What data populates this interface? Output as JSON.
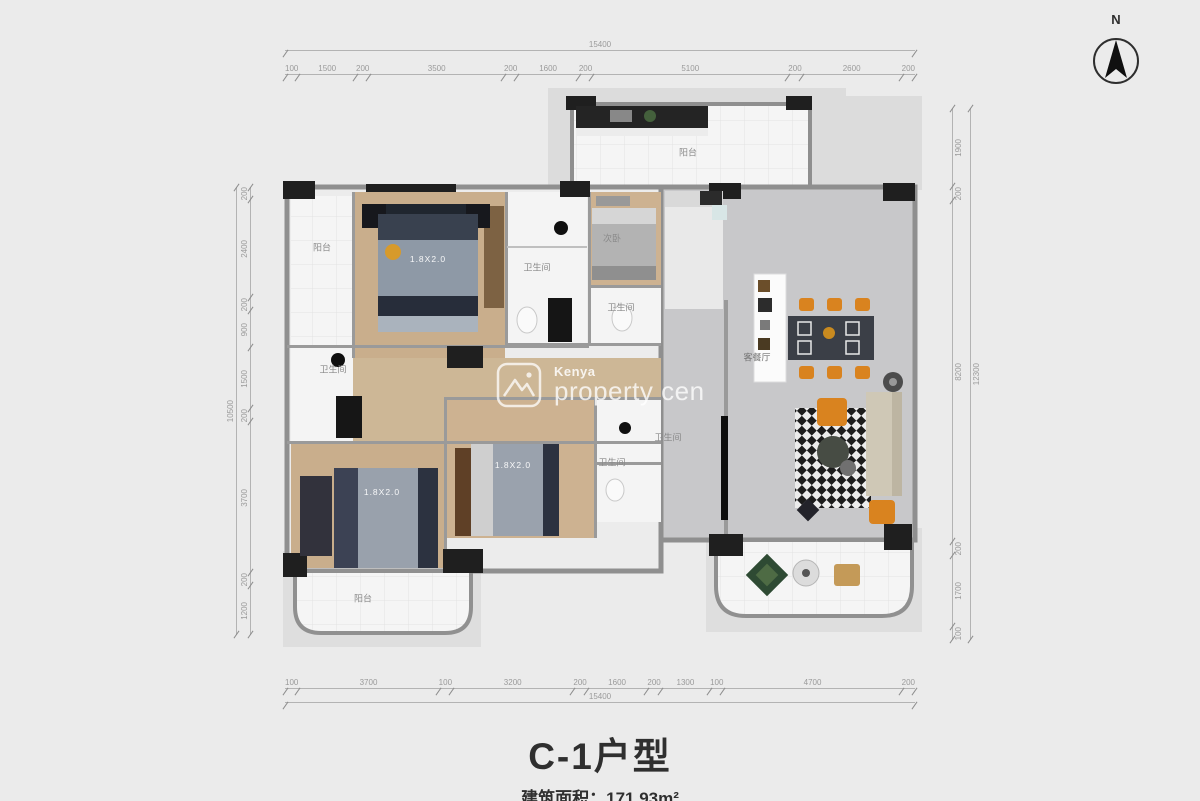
{
  "page": {
    "bg": "#ebebeb",
    "title": "C-1户型",
    "area_label": "建筑面积：171.93m²"
  },
  "compass": {
    "label": "N"
  },
  "watermark": {
    "brand": "Kenya",
    "text": "property cen"
  },
  "dimensions": {
    "top": {
      "total": "15400",
      "segments": [
        "100",
        "1500",
        "200",
        "3500",
        "200",
        "1600",
        "200",
        "5100",
        "200",
        "2600",
        "200"
      ]
    },
    "bottom": {
      "total": "15400",
      "segments": [
        "100",
        "3700",
        "100",
        "3200",
        "200",
        "1600",
        "200",
        "1300",
        "100",
        "4700",
        "200"
      ]
    },
    "left": {
      "total": "10500",
      "segments": [
        "200",
        "2400",
        "200",
        "900",
        "1500",
        "200",
        "3700",
        "200",
        "1200"
      ]
    },
    "right": {
      "total": "12300",
      "segments": [
        "1900",
        "200",
        "8200",
        "200",
        "1700",
        "100"
      ]
    }
  },
  "colors": {
    "accent_orange": "#d9831f",
    "wood_floor": "#c9ae8c",
    "marble_floor": "#c8c8ca",
    "wall_gray": "#8f8f8f",
    "column_black": "#1f1f1f"
  },
  "plan": {
    "labels": [
      {
        "text": "阳台",
        "x": 322,
        "y": 247,
        "style": ""
      },
      {
        "text": "阳台",
        "x": 688,
        "y": 152,
        "style": ""
      },
      {
        "text": "阳台",
        "x": 363,
        "y": 598,
        "style": ""
      },
      {
        "text": "卫生间",
        "x": 537,
        "y": 267,
        "style": ""
      },
      {
        "text": "卫生间",
        "x": 621,
        "y": 307,
        "style": ""
      },
      {
        "text": "卫生间",
        "x": 333,
        "y": 369,
        "style": ""
      },
      {
        "text": "卫生间",
        "x": 668,
        "y": 437,
        "style": ""
      },
      {
        "text": "卫生间",
        "x": 612,
        "y": 462,
        "style": ""
      },
      {
        "text": "次卧",
        "x": 612,
        "y": 238,
        "style": ""
      },
      {
        "text": "客餐厅",
        "x": 757,
        "y": 357,
        "style": "dark"
      },
      {
        "text": "1.8X2.0",
        "x": 428,
        "y": 259,
        "style": "bed"
      },
      {
        "text": "1.8X2.0",
        "x": 382,
        "y": 492,
        "style": "bed"
      },
      {
        "text": "1.8X2.0",
        "x": 513,
        "y": 465,
        "style": "bed"
      }
    ]
  }
}
